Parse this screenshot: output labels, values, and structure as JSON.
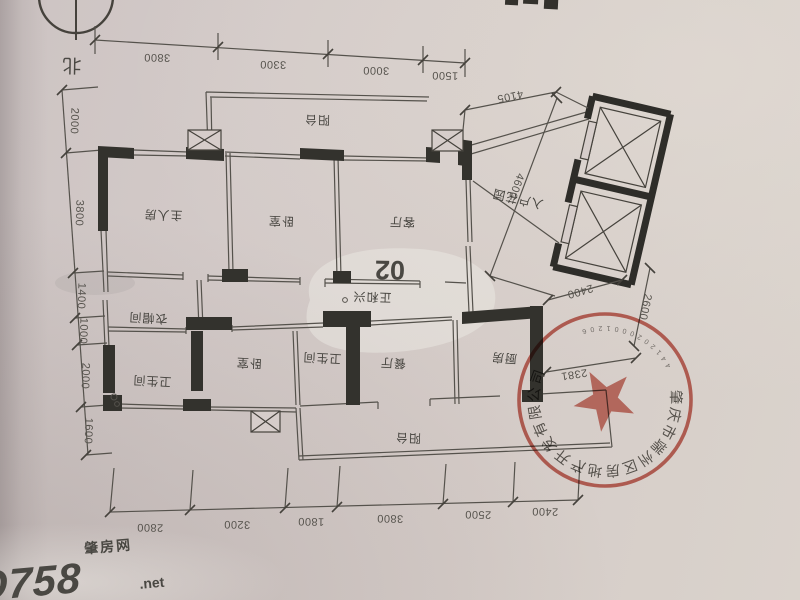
{
  "compass": {
    "north_label": "北"
  },
  "unit": {
    "number": "02"
  },
  "rooms": {
    "balcony_top": "阳台",
    "master": "主人房",
    "bedroom1": "卧室",
    "living": "客厅",
    "entry_garden": "入户花园",
    "cloakroom": "衣帽间",
    "bath1": "卫生间",
    "bedroom2": "卧室",
    "bath2": "卫生间",
    "dining": "餐厅",
    "kitchen": "厨房",
    "balcony_bottom": "阳台"
  },
  "dimensions": {
    "top": [
      "3800",
      "3300",
      "3000",
      "1500"
    ],
    "left": [
      "2000",
      "3800",
      "1400",
      "1000",
      "2000",
      "1600"
    ],
    "bottom": [
      "2800",
      "3200",
      "1800",
      "3800",
      "2500",
      "2400"
    ],
    "entry_diag": "4105",
    "lift_side": "4600",
    "lift_width": "2400",
    "lift_right": "2600",
    "kitchen_right": "2381"
  },
  "stamp": {
    "company": "肇庆市端州区房地产开发有限公司",
    "serial": "4412020001206"
  },
  "watermarks": {
    "center": "正和兴",
    "site_cn": "肇房网",
    "site_logo": "hO758",
    "site_tld": ".net"
  },
  "colors": {
    "paper": "#d3cac8",
    "line": "#55524c",
    "wall": "#33322d",
    "stamp_red": "#c4564a",
    "dim_text": "#56534d"
  }
}
